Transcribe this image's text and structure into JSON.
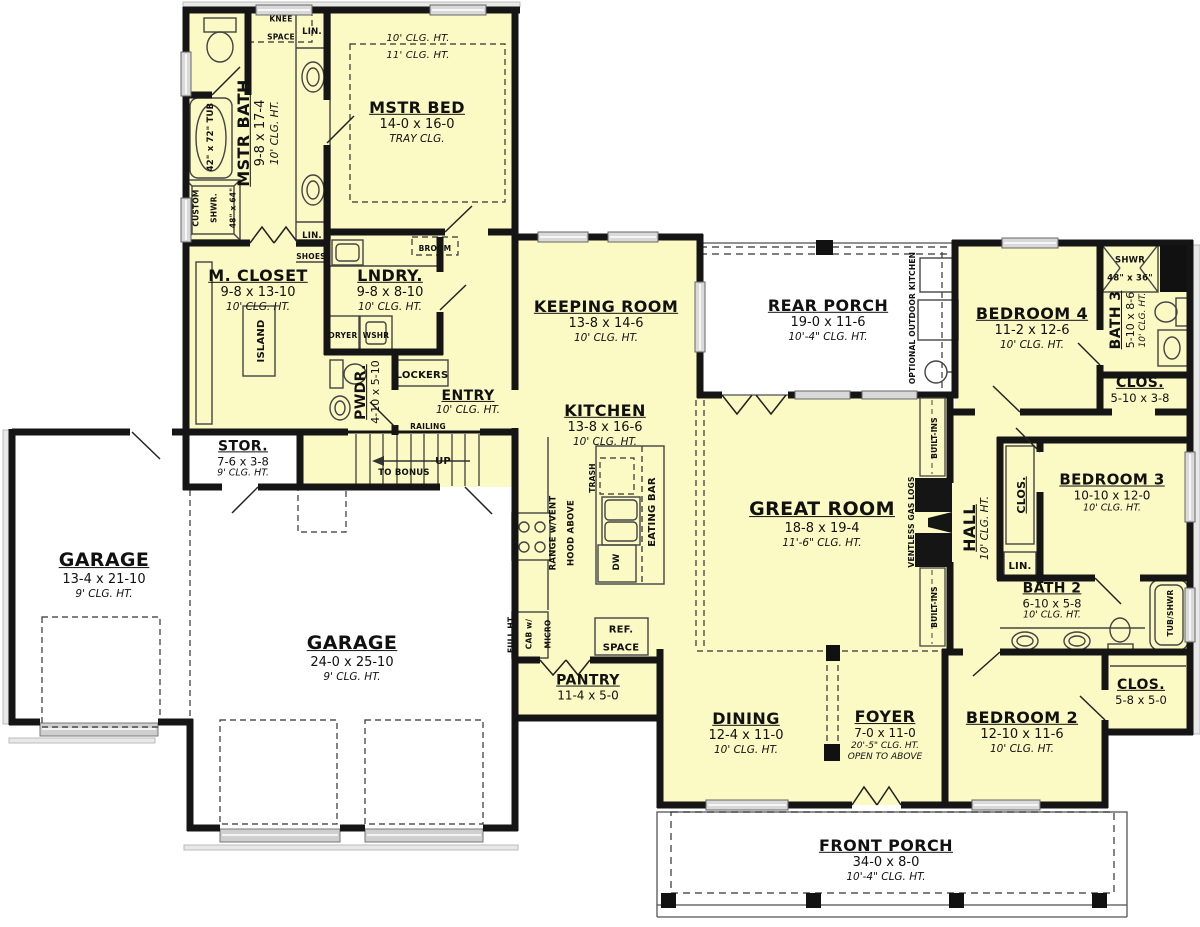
{
  "rooms": {
    "mstr_bed": {
      "name": "MSTR BED",
      "dim": "14-0 x 16-0",
      "note": "TRAY CLG."
    },
    "mstr_bed_clg1": "10' CLG. HT.",
    "mstr_bed_clg2": "11' CLG. HT.",
    "mstr_bath": {
      "name": "MSTR BATH",
      "dim": "9-8 x 17-4",
      "clg": "10' CLG. HT."
    },
    "m_closet": {
      "name": "M. CLOSET",
      "dim": "9-8 x 13-10",
      "clg": "10' CLG. HT."
    },
    "lndry": {
      "name": "LNDRY.",
      "dim": "9-8 x 8-10",
      "clg": "10' CLG. HT."
    },
    "pwdr": {
      "name": "PWDR.",
      "dim": "4-10 x 5-10"
    },
    "entry": {
      "name": "ENTRY",
      "clg": "10' CLG. HT."
    },
    "stor": {
      "name": "STOR.",
      "dim": "7-6 x 3-8",
      "clg": "9' CLG. HT."
    },
    "garage1": {
      "name": "GARAGE",
      "dim": "13-4 x 21-10",
      "clg": "9' CLG. HT."
    },
    "garage2": {
      "name": "GARAGE",
      "dim": "24-0 x 25-10",
      "clg": "9' CLG. HT."
    },
    "keeping": {
      "name": "KEEPING ROOM",
      "dim": "13-8 x 14-6",
      "clg": "10' CLG. HT."
    },
    "kitchen": {
      "name": "KITCHEN",
      "dim": "13-8 x 16-6",
      "clg": "10' CLG. HT."
    },
    "pantry": {
      "name": "PANTRY",
      "dim": "11-4 x 5-0"
    },
    "rear_porch": {
      "name": "REAR PORCH",
      "dim": "19-0 x 11-6",
      "clg": "10'-4\" CLG. HT."
    },
    "great": {
      "name": "GREAT ROOM",
      "dim": "18-8 x 19-4",
      "clg": "11'-6\" CLG. HT."
    },
    "hall": {
      "name": "HALL",
      "clg": "10' CLG. HT."
    },
    "bed4": {
      "name": "BEDROOM 4",
      "dim": "11-2 x 12-6",
      "clg": "10' CLG. HT."
    },
    "bath3": {
      "name": "BATH 3",
      "dim": "5-10 x 8-6",
      "clg": "10' CLG. HT."
    },
    "clos3": {
      "name": "CLOS.",
      "dim": "5-10 x 3-8"
    },
    "bed3": {
      "name": "BEDROOM 3",
      "dim": "10-10 x 12-0",
      "clg": "10' CLG. HT."
    },
    "bath2": {
      "name": "BATH 2",
      "dim": "6-10 x 5-8",
      "clg": "10' CLG. HT."
    },
    "bed2": {
      "name": "BEDROOM 2",
      "dim": "12-10 x 11-6",
      "clg": "10' CLG. HT."
    },
    "clos2": {
      "name": "CLOS.",
      "dim": "5-8 x 5-0"
    },
    "dining": {
      "name": "DINING",
      "dim": "12-4 x 11-0",
      "clg": "10' CLG. HT."
    },
    "foyer": {
      "name": "FOYER",
      "dim": "7-0 x 11-0",
      "clg": "20'-5\" CLG. HT.",
      "note": "OPEN TO ABOVE"
    },
    "front_porch": {
      "name": "FRONT PORCH",
      "dim": "34-0 x 8-0",
      "clg": "10'-4\" CLG. HT."
    }
  },
  "ann": {
    "knee1": "KNEE",
    "knee2": "SPACE",
    "lin": "LIN.",
    "shoes": "SHOES",
    "broom": "BROOM",
    "dryer": "DRYER",
    "wshr": "WSHR",
    "lockers": "LOCKERS",
    "island": "ISLAND",
    "tub_label": "42\" x 72\" TUB",
    "cshwr1": "CUSTOM",
    "cshwr2": "SHWR.",
    "cshwr3": "48\" x 64\"",
    "range1": "RANGE w/VENT",
    "range2": "HOOD ABOVE",
    "cab1": "FULL HT.",
    "cab2": "CAB w/",
    "cab3": "MICRO",
    "trash": "TRASH",
    "dw": "DW",
    "eating_bar": "EATING BAR",
    "ref1": "REF.",
    "ref2": "SPACE",
    "built_ins": "BUILT-INS",
    "ventless": "VENTLESS GAS LOGS",
    "clos_hall": "CLOS.",
    "tub_shwr": "TUB/SHWR",
    "shwr3a": "SHWR",
    "shwr3b": "48\" x 36\"",
    "outdoor_kitchen": "OPTIONAL OUTDOOR KITCHEN",
    "railing": "RAILING",
    "up": "UP",
    "to_bonus": "TO BONUS"
  },
  "colors": {
    "room_fill": "#fbf9c4",
    "wall": "#151515",
    "porch_line": "#555555",
    "window": "#c8c8c8"
  }
}
